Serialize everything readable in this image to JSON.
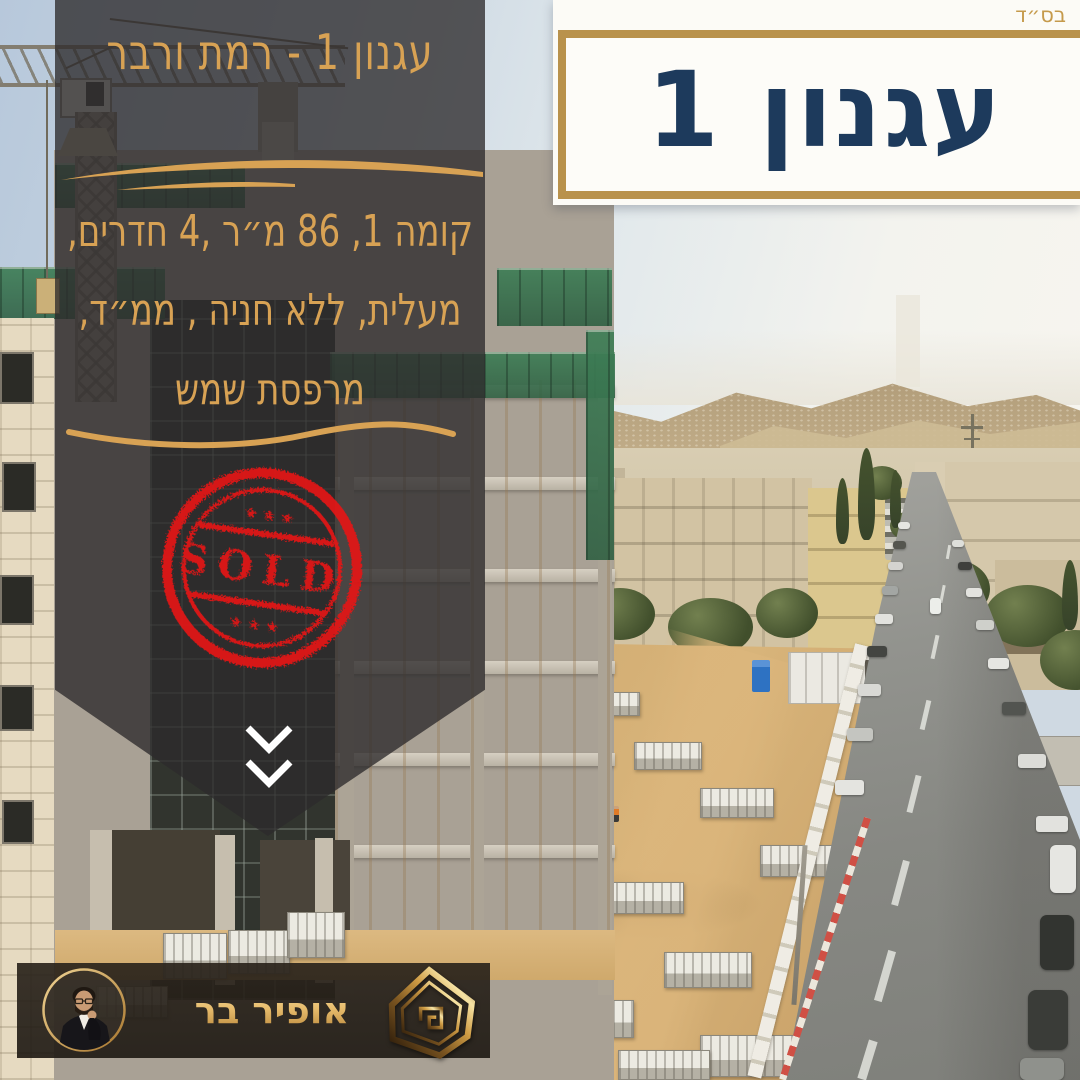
{
  "header": {
    "bsd": "בס״ד"
  },
  "project_card": {
    "name": "עגנון 1"
  },
  "info_panel": {
    "title": "עגנון 1 - רמת ורבר",
    "detail_lines": [
      "קומה 1, 86 מ״ר ,4 חדרים,",
      "מעלית, ללא חניה , ממ״ד,",
      "מרפסת שמש"
    ]
  },
  "sold_stamp": {
    "label": "SOLD",
    "stars": "★ ★ ★",
    "color": "#e31717"
  },
  "agent_bar": {
    "agent_name": "אופיר בר"
  },
  "icons": {
    "scroll_hint": "double-chevron-down-icon",
    "logo": "house-outline-icon",
    "stamp": "sold-grunge-stamp"
  },
  "colors": {
    "gold": "#d8a254",
    "navy": "#1d3a5c",
    "stamp_red": "#e31717",
    "card_border_gold": "#b9924c",
    "panel_overlay": "rgba(45,42,44,0.78)"
  }
}
